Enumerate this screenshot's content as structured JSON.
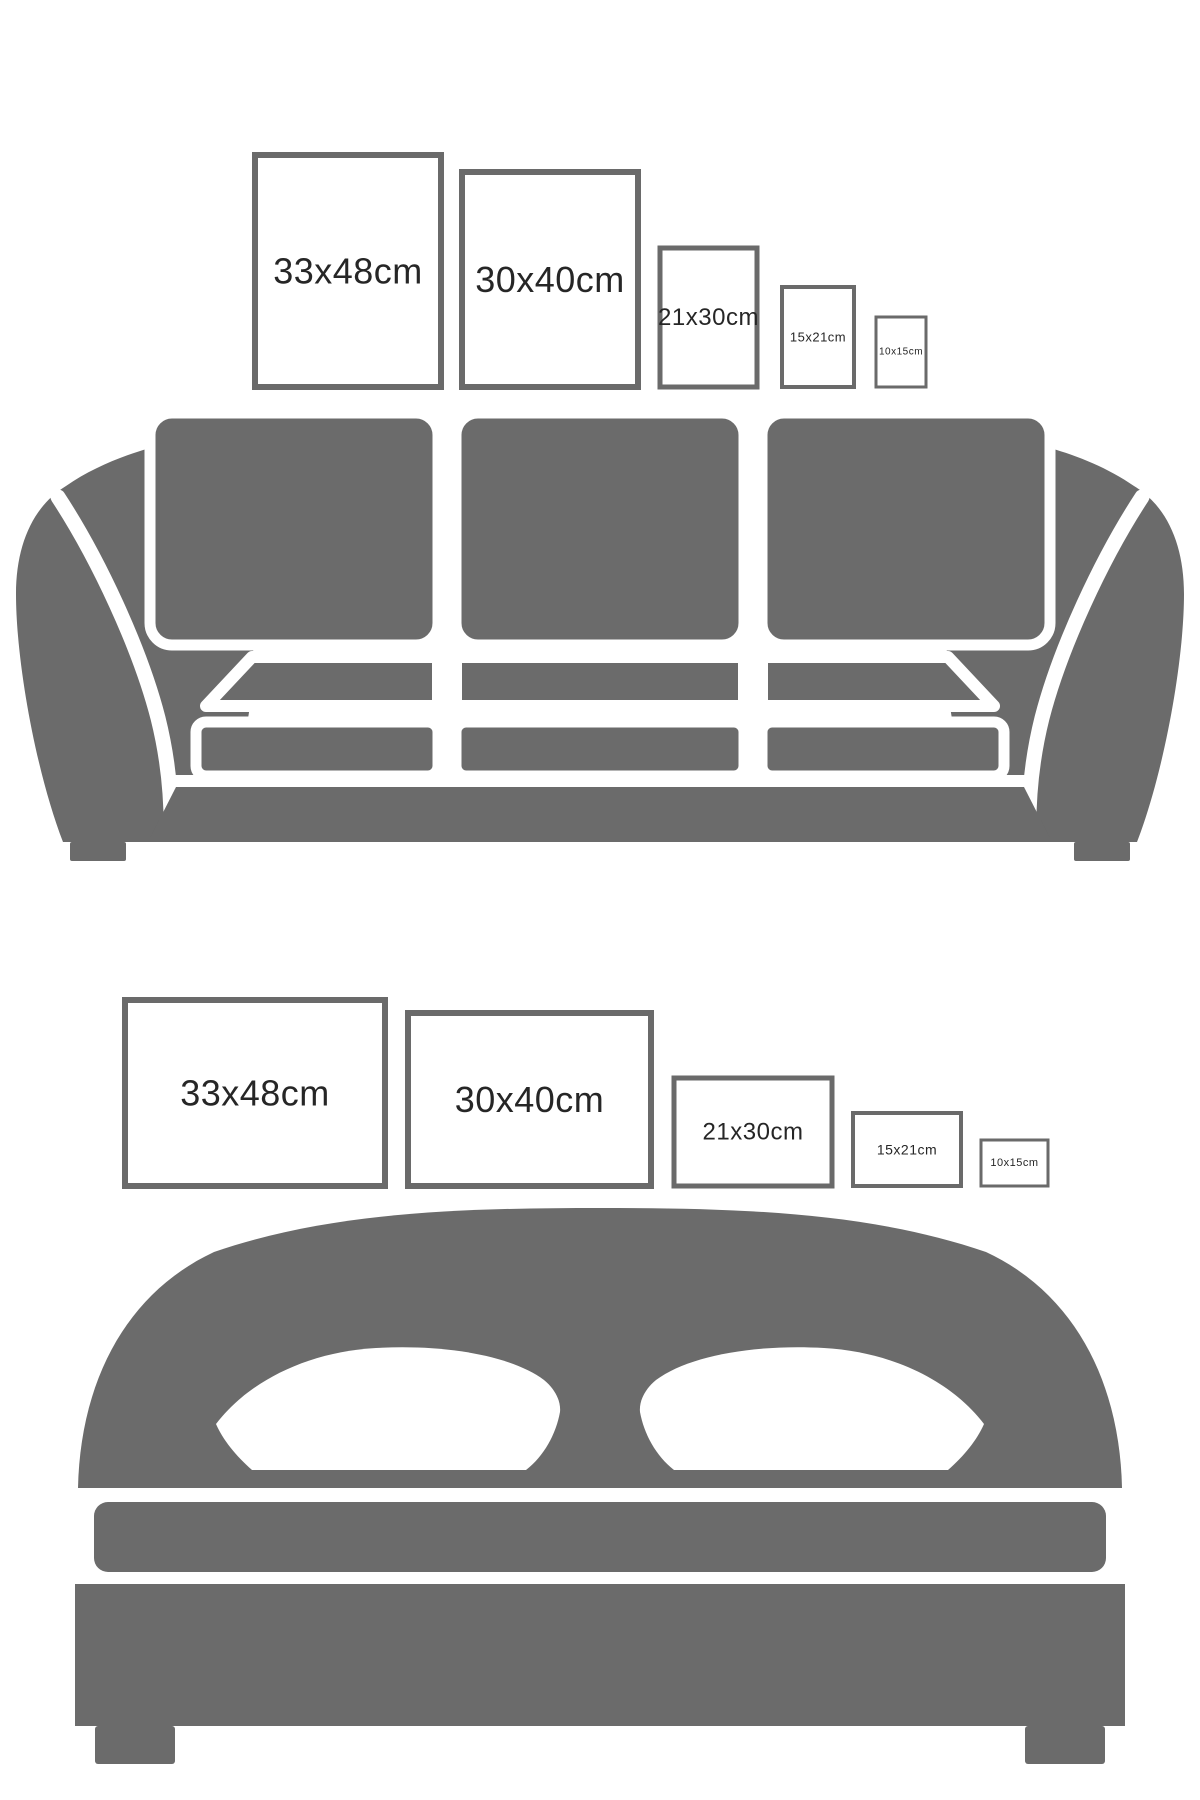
{
  "colors": {
    "furniture": "#6b6b6b",
    "frame_border": "#6a6a6a",
    "label_text": "#262626",
    "background": "#ffffff"
  },
  "sections": [
    {
      "id": "sofa",
      "furniture": "sofa",
      "frames": [
        {
          "label": "33x48cm",
          "x": 255,
          "y": 155,
          "w": 186,
          "h": 232,
          "fontSize": 36,
          "border": 6
        },
        {
          "label": "30x40cm",
          "x": 462,
          "y": 172,
          "w": 176,
          "h": 215,
          "fontSize": 36,
          "border": 6
        },
        {
          "label": "21x30cm",
          "x": 660,
          "y": 248,
          "w": 97,
          "h": 139,
          "fontSize": 24,
          "border": 5
        },
        {
          "label": "15x21cm",
          "x": 782,
          "y": 287,
          "w": 72,
          "h": 100,
          "fontSize": 13,
          "border": 4
        },
        {
          "label": "10x15cm",
          "x": 876,
          "y": 317,
          "w": 50,
          "h": 70,
          "fontSize": 10,
          "border": 3
        }
      ]
    },
    {
      "id": "bed",
      "furniture": "bed",
      "frames": [
        {
          "label": "33x48cm",
          "x": 125,
          "y": 1000,
          "w": 260,
          "h": 186,
          "fontSize": 36,
          "border": 6
        },
        {
          "label": "30x40cm",
          "x": 408,
          "y": 1013,
          "w": 243,
          "h": 173,
          "fontSize": 36,
          "border": 6
        },
        {
          "label": "21x30cm",
          "x": 674,
          "y": 1078,
          "w": 158,
          "h": 108,
          "fontSize": 24,
          "border": 5
        },
        {
          "label": "15x21cm",
          "x": 853,
          "y": 1113,
          "w": 108,
          "h": 73,
          "fontSize": 14,
          "border": 4
        },
        {
          "label": "10x15cm",
          "x": 981,
          "y": 1140,
          "w": 67,
          "h": 46,
          "fontSize": 11,
          "border": 3
        }
      ]
    }
  ]
}
